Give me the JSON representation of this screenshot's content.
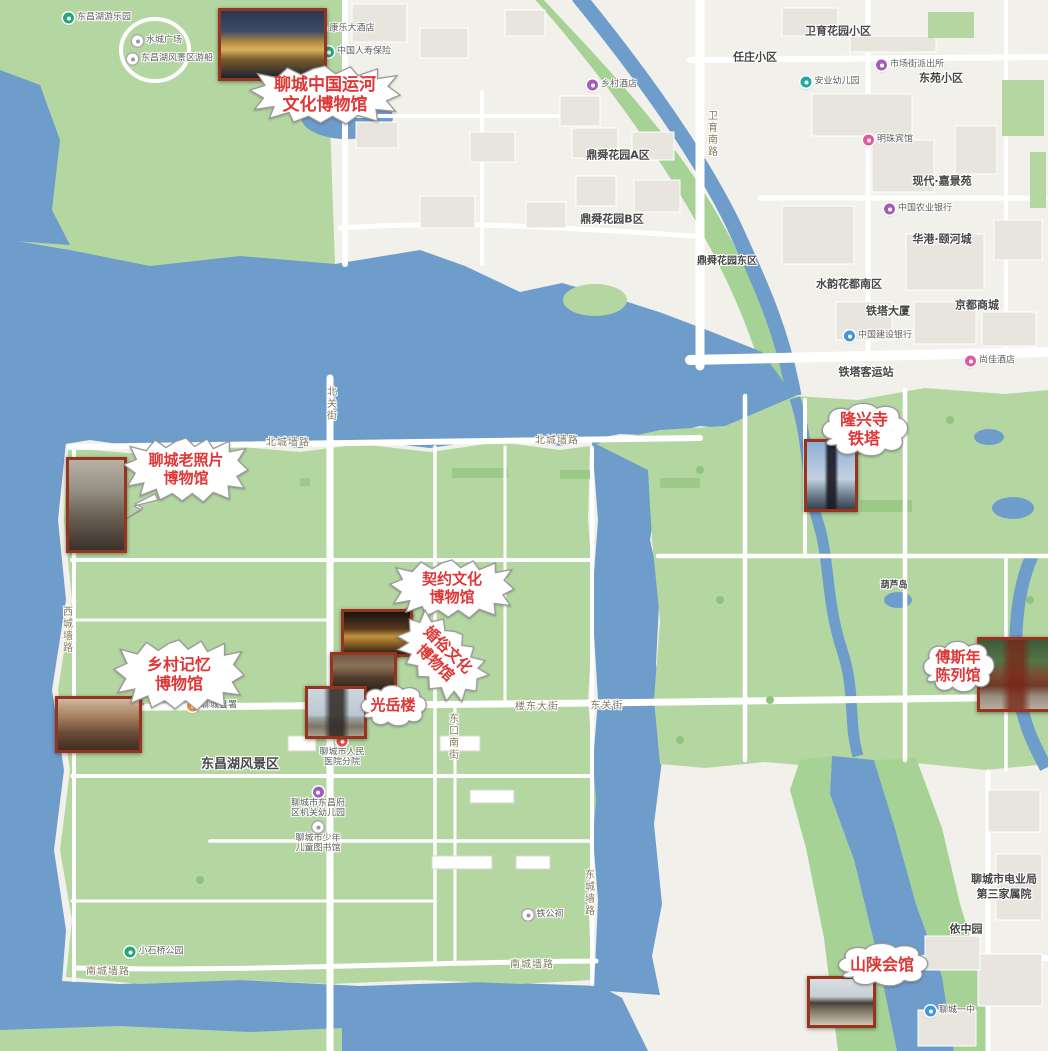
{
  "colors": {
    "water": "#6e9ccb",
    "park": "#b4d7a2",
    "park_dark": "#9cc988",
    "urban": "#f2f0ea",
    "building": "#e8e5df",
    "road": "#ffffff",
    "callout_text": "#e03636",
    "photo_border": "#96341f"
  },
  "callouts": [
    {
      "id": "canal-museum",
      "lines": [
        "聊城中国运河",
        "文化博物馆"
      ],
      "shape": "burst",
      "x": 250,
      "y": 66,
      "w": 150,
      "h": 58,
      "font": 17,
      "rotate": 0
    },
    {
      "id": "old-photo-museum",
      "lines": [
        "聊城老照片",
        "博物馆"
      ],
      "shape": "burst",
      "x": 124,
      "y": 438,
      "w": 124,
      "h": 64,
      "font": 15,
      "rotate": 0
    },
    {
      "id": "rural-memory-museum",
      "lines": [
        "乡村记忆",
        "博物馆"
      ],
      "shape": "burst",
      "x": 114,
      "y": 640,
      "w": 130,
      "h": 70,
      "font": 16,
      "rotate": 0
    },
    {
      "id": "contract-culture-museum",
      "lines": [
        "契约文化",
        "博物馆"
      ],
      "shape": "burst",
      "x": 390,
      "y": 560,
      "w": 124,
      "h": 58,
      "font": 15,
      "rotate": 0
    },
    {
      "id": "marriage-culture-museum",
      "lines": [
        "婚俗文化",
        "博物馆"
      ],
      "shape": "burst",
      "x": 392,
      "y": 626,
      "w": 98,
      "h": 62,
      "font": 15,
      "rotate": 44
    },
    {
      "id": "guangyue-tower",
      "lines": [
        "光岳楼"
      ],
      "shape": "cloud",
      "x": 358,
      "y": 686,
      "w": 70,
      "h": 40,
      "font": 15,
      "rotate": 0
    },
    {
      "id": "longxing-pagoda",
      "lines": [
        "隆兴寺",
        "铁塔"
      ],
      "shape": "cloud",
      "x": 818,
      "y": 404,
      "w": 92,
      "h": 52,
      "font": 16,
      "rotate": 0
    },
    {
      "id": "fusinian-hall",
      "lines": [
        "傅斯年",
        "陈列馆"
      ],
      "shape": "cloud",
      "x": 920,
      "y": 642,
      "w": 76,
      "h": 50,
      "font": 15,
      "rotate": 0
    },
    {
      "id": "shanshan-guildhall",
      "lines": [
        "山陕会馆"
      ],
      "shape": "cloud",
      "x": 834,
      "y": 944,
      "w": 96,
      "h": 42,
      "font": 16,
      "rotate": 0
    }
  ],
  "photos": [
    {
      "id": "canal-museum-photo",
      "x": 218,
      "y": 8,
      "w": 103,
      "h": 67,
      "style": "night-building"
    },
    {
      "id": "old-photo-museum-photo",
      "x": 66,
      "y": 457,
      "w": 55,
      "h": 90,
      "style": "sepia-gate"
    },
    {
      "id": "rural-memory-photo",
      "x": 55,
      "y": 696,
      "w": 81,
      "h": 51,
      "style": "dusk-street"
    },
    {
      "id": "contract-interior-photo",
      "x": 341,
      "y": 609,
      "w": 66,
      "h": 42,
      "style": "amber-interior"
    },
    {
      "id": "marriage-facade-photo",
      "x": 330,
      "y": 652,
      "w": 61,
      "h": 37,
      "style": "wood-facade"
    },
    {
      "id": "guangyue-photo",
      "x": 305,
      "y": 686,
      "w": 56,
      "h": 47,
      "style": "tower-sky"
    },
    {
      "id": "pagoda-photo",
      "x": 804,
      "y": 439,
      "w": 48,
      "h": 67,
      "style": "pagoda-sky"
    },
    {
      "id": "fusinian-photo",
      "x": 977,
      "y": 637,
      "w": 71,
      "h": 69,
      "style": "temple-gate"
    },
    {
      "id": "shanshan-photo",
      "x": 807,
      "y": 976,
      "w": 63,
      "h": 46,
      "style": "guild-roof"
    }
  ],
  "districts": [
    {
      "label": "任庄小区",
      "x": 755,
      "y": 57,
      "size": 11
    },
    {
      "label": "卫育花园小区",
      "x": 838,
      "y": 31,
      "size": 11
    },
    {
      "label": "东苑小区",
      "x": 941,
      "y": 78,
      "size": 11
    },
    {
      "label": "现代·嘉景苑",
      "x": 942,
      "y": 181,
      "size": 11
    },
    {
      "label": "鼎舜花园A区",
      "x": 618,
      "y": 155,
      "size": 11
    },
    {
      "label": "鼎舜花园B区",
      "x": 612,
      "y": 219,
      "size": 11
    },
    {
      "label": "鼎舜花园东区",
      "x": 727,
      "y": 262,
      "size": 10
    },
    {
      "label": "水韵花都南区",
      "x": 849,
      "y": 284,
      "size": 11
    },
    {
      "label": "铁塔大厦",
      "x": 888,
      "y": 311,
      "size": 11
    },
    {
      "label": "京都商城",
      "x": 977,
      "y": 305,
      "size": 11
    },
    {
      "label": "铁塔客运站",
      "x": 866,
      "y": 372,
      "size": 11
    },
    {
      "label": "华港·颐河城",
      "x": 942,
      "y": 239,
      "size": 11
    },
    {
      "label": "东昌湖风景区",
      "x": 240,
      "y": 765,
      "size": 13
    },
    {
      "label": "依中园",
      "x": 966,
      "y": 929,
      "size": 11
    },
    {
      "label": "葫芦岛",
      "x": 894,
      "y": 586,
      "size": 9
    },
    {
      "label": "聊城市电业局",
      "x": 1004,
      "y": 879,
      "size": 11
    },
    {
      "label": "第三家属院",
      "x": 1004,
      "y": 894,
      "size": 11
    }
  ],
  "streets": [
    {
      "label": "卫育南路",
      "x": 711,
      "y": 134,
      "v": true
    },
    {
      "label": "北城墙路",
      "x": 288,
      "y": 441,
      "v": false
    },
    {
      "label": "北城墙路",
      "x": 557,
      "y": 439,
      "v": false
    },
    {
      "label": "北关街",
      "x": 330,
      "y": 404,
      "v": true
    },
    {
      "label": "楼东大街",
      "x": 537,
      "y": 705,
      "v": false
    },
    {
      "label": "东关街",
      "x": 607,
      "y": 704,
      "v": false
    },
    {
      "label": "南城墙路",
      "x": 108,
      "y": 970,
      "v": false
    },
    {
      "label": "南城墙路",
      "x": 532,
      "y": 963,
      "v": false
    },
    {
      "label": "西城墙路",
      "x": 66,
      "y": 630,
      "v": true
    },
    {
      "label": "东城墙路",
      "x": 588,
      "y": 893,
      "v": true
    },
    {
      "label": "东口南街",
      "x": 452,
      "y": 737,
      "v": true
    }
  ],
  "pois": [
    {
      "label": "东昌湖游乐园",
      "x": 97,
      "y": 18,
      "pin": "green"
    },
    {
      "label": "水城广场",
      "x": 157,
      "y": 41,
      "pin": "white"
    },
    {
      "label": "东昌湖风景区游船",
      "x": 170,
      "y": 59,
      "pin": "white"
    },
    {
      "label": "康乐大酒店",
      "x": 345,
      "y": 29,
      "pin": "green"
    },
    {
      "label": "中国人寿保险",
      "x": 357,
      "y": 52,
      "pin": "green"
    },
    {
      "label": "乡村酒店",
      "x": 612,
      "y": 85,
      "pin": "purple"
    },
    {
      "label": "市场街派出所",
      "x": 910,
      "y": 65,
      "pin": "purple"
    },
    {
      "label": "安业幼儿园",
      "x": 830,
      "y": 82,
      "pin": "teal"
    },
    {
      "label": "明珠宾馆",
      "x": 888,
      "y": 140,
      "pin": "pink"
    },
    {
      "label": "中国农业银行",
      "x": 918,
      "y": 209,
      "pin": "purple"
    },
    {
      "label": "中国建设银行",
      "x": 878,
      "y": 336,
      "pin": "blue"
    },
    {
      "label": "尚佳酒店",
      "x": 990,
      "y": 361,
      "pin": "pink"
    },
    {
      "label": "聊城县署",
      "x": 212,
      "y": 706,
      "pin": "orange"
    },
    {
      "label": "铁公祠",
      "x": 543,
      "y": 915,
      "pin": "white"
    },
    {
      "label": "小石桥公园",
      "x": 154,
      "y": 952,
      "pin": "green"
    },
    {
      "label": "聊城一中",
      "x": 950,
      "y": 1011,
      "pin": "blue"
    },
    {
      "label": "聊城市人民医院分院",
      "x": 342,
      "y": 752,
      "pin": "red",
      "lines": [
        "聊城市人民",
        "医院分院"
      ]
    },
    {
      "label": "聊城市东昌府区机关幼儿园",
      "x": 318,
      "y": 803,
      "pin": "purple",
      "lines": [
        "聊城市东昌府",
        "区机关幼儿园"
      ]
    },
    {
      "label": "聊城市少年儿童图书馆",
      "x": 318,
      "y": 838,
      "pin": "white",
      "lines": [
        "聊城市少年",
        "儿童图书馆"
      ]
    }
  ]
}
